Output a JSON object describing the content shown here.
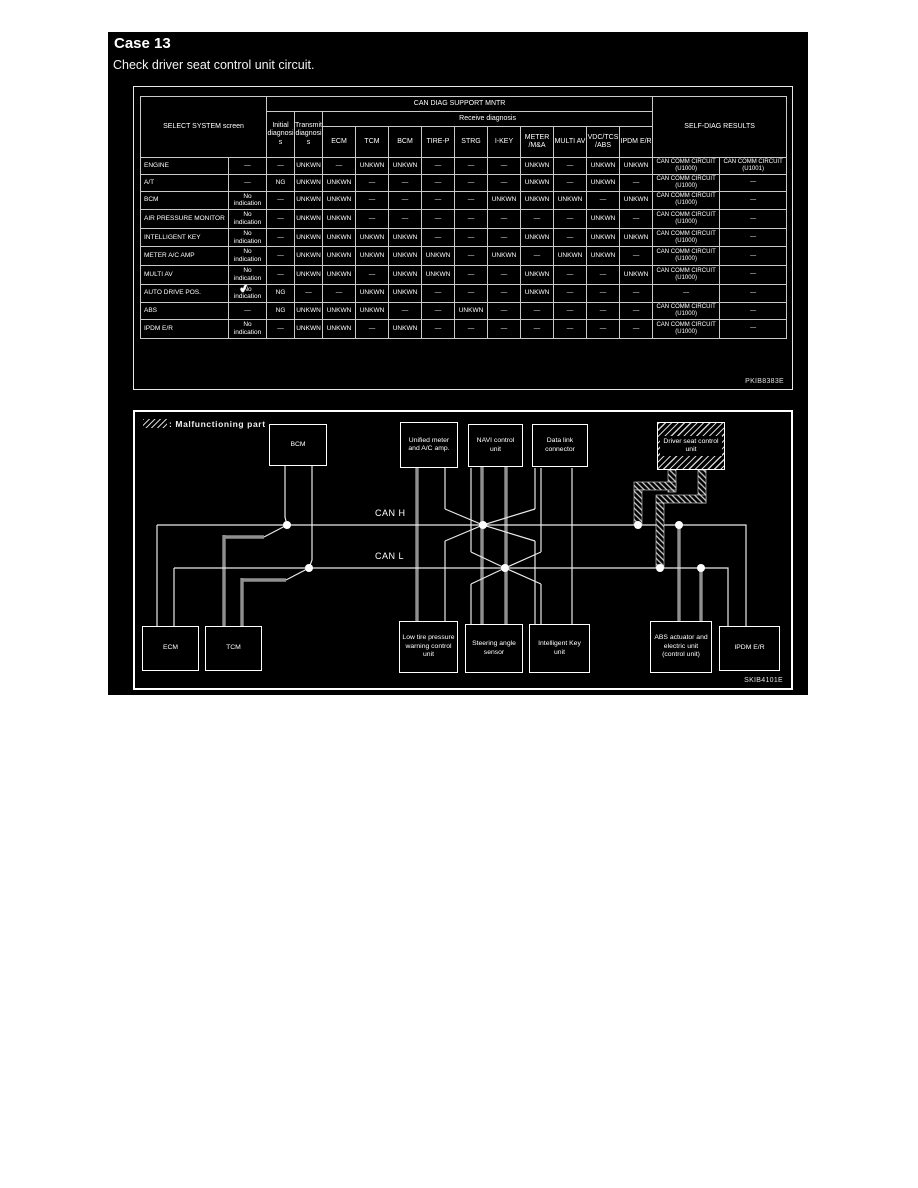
{
  "page": {
    "case_title": "Case 13",
    "subtitle": "Check driver seat control unit circuit."
  },
  "diag_table": {
    "figure_code": "PKIB8383E",
    "check_glyph": "✓",
    "headers": {
      "select_system": "SELECT SYSTEM screen",
      "can_diag": "CAN DIAG SUPPORT MNTR",
      "initial": "Initial diagnosis",
      "transmit": "Transmit diagnosis",
      "receive": "Receive diagnosis",
      "self_diag": "SELF-DIAG RESULTS"
    },
    "receive_columns": [
      "ECM",
      "TCM",
      "BCM",
      "TIRE-P",
      "STRG",
      "I-KEY",
      "METER /M&A",
      "MULTI AV",
      "VDC/TCS /ABS",
      "IPDM E/R"
    ],
    "rows": [
      {
        "name": "ENGINE",
        "checked": false,
        "cells": [
          "—",
          "—",
          "UNKWN",
          "—",
          "UNKWN",
          "UNKWN",
          "—",
          "—",
          "—",
          "UNKWN",
          "—",
          "UNKWN",
          "UNKWN",
          "CAN COMM CIRCUIT (U1000)",
          "CAN COMM CIRCUIT (U1001)"
        ]
      },
      {
        "name": "A/T",
        "checked": false,
        "cells": [
          "—",
          "NG",
          "UNKWN",
          "UNKWN",
          "—",
          "—",
          "—",
          "—",
          "—",
          "UNKWN",
          "—",
          "UNKWN",
          "—",
          "CAN COMM CIRCUIT (U1000)",
          "—"
        ]
      },
      {
        "name": "BCM",
        "checked": false,
        "cells": [
          "No indication",
          "—",
          "UNKWN",
          "UNKWN",
          "—",
          "—",
          "—",
          "—",
          "UNKWN",
          "UNKWN",
          "UNKWN",
          "—",
          "UNKWN",
          "CAN COMM CIRCUIT (U1000)",
          "—"
        ]
      },
      {
        "name": "AIR PRESSURE MONITOR",
        "checked": false,
        "cells": [
          "No indication",
          "—",
          "UNKWN",
          "UNKWN",
          "—",
          "—",
          "—",
          "—",
          "—",
          "—",
          "—",
          "UNKWN",
          "—",
          "CAN COMM CIRCUIT (U1000)",
          "—"
        ]
      },
      {
        "name": "INTELLIGENT KEY",
        "checked": false,
        "cells": [
          "No indication",
          "—",
          "UNKWN",
          "UNKWN",
          "UNKWN",
          "UNKWN",
          "—",
          "—",
          "—",
          "UNKWN",
          "—",
          "UNKWN",
          "UNKWN",
          "CAN COMM CIRCUIT (U1000)",
          "—"
        ]
      },
      {
        "name": "METER A/C AMP",
        "checked": false,
        "cells": [
          "No indication",
          "—",
          "UNKWN",
          "UNKWN",
          "UNKWN",
          "UNKWN",
          "UNKWN",
          "—",
          "UNKWN",
          "—",
          "UNKWN",
          "UNKWN",
          "—",
          "CAN COMM CIRCUIT (U1000)",
          "—"
        ]
      },
      {
        "name": "MULTI AV",
        "checked": false,
        "cells": [
          "No indication",
          "—",
          "UNKWN",
          "UNKWN",
          "—",
          "UNKWN",
          "UNKWN",
          "—",
          "—",
          "UNKWN",
          "—",
          "—",
          "UNKWN",
          "CAN COMM CIRCUIT (U1000)",
          "—"
        ]
      },
      {
        "name": "AUTO DRIVE POS.",
        "checked": true,
        "cells": [
          "No indication",
          "NG",
          "—",
          "—",
          "UNKWN",
          "UNKWN",
          "—",
          "—",
          "—",
          "UNKWN",
          "—",
          "—",
          "—",
          "—",
          "—"
        ]
      },
      {
        "name": "ABS",
        "checked": false,
        "cells": [
          "—",
          "NG",
          "UNKWN",
          "UNKWN",
          "UNKWN",
          "—",
          "—",
          "UNKWN",
          "—",
          "—",
          "—",
          "—",
          "—",
          "CAN COMM CIRCUIT (U1000)",
          "—"
        ]
      },
      {
        "name": "IPDM E/R",
        "checked": false,
        "cells": [
          "No indication",
          "—",
          "UNKWN",
          "UNKWN",
          "—",
          "UNKWN",
          "—",
          "—",
          "—",
          "—",
          "—",
          "—",
          "—",
          "CAN COMM CIRCUIT (U1000)",
          "—"
        ]
      }
    ]
  },
  "diagram": {
    "figure_code": "SKIB4101E",
    "legend_label": ": Malfunctioning part",
    "can_h": "CAN H",
    "can_l": "CAN L",
    "boxes": {
      "bcm": "BCM",
      "unified": "Unified meter and A/C amp.",
      "navi": "NAVI control unit",
      "datalink": "Data link connector",
      "driver_seat": "Driver seat control unit",
      "ecm": "ECM",
      "tcm": "TCM",
      "low_tire": "Low tire pressure warning control unit",
      "steering": "Steering angle sensor",
      "intelligent_key": "Intelligent Key unit",
      "abs": "ABS actuator and electric unit (control unit)",
      "ipdm": "IPDM E/R"
    }
  }
}
